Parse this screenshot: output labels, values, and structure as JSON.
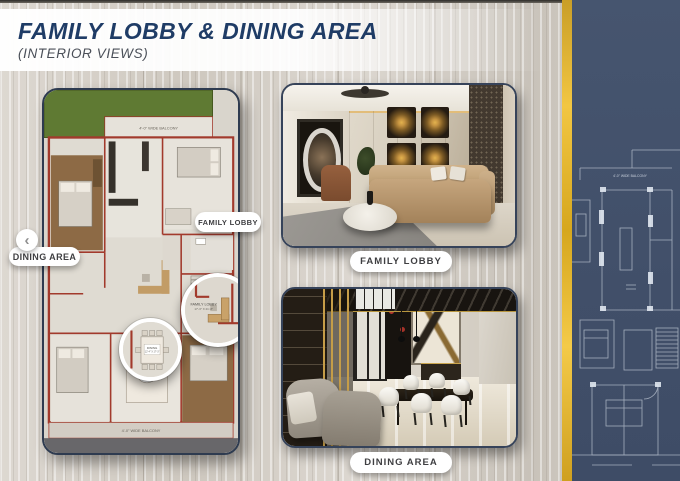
{
  "header": {
    "title": "FAMILY LOBBY & DINING AREA",
    "subtitle": "(INTERIOR VIEWS)"
  },
  "floorplan": {
    "balcony_top": "4'-0\" WIDE BALCONY",
    "balcony_bottom": "4'-0\" WIDE BALCONY",
    "magnifiers": {
      "family_lobby": {
        "label": "FAMILY LOBBY",
        "dims": "17'-3\" X 21'-8\""
      },
      "dining": {
        "label": "DINING",
        "dims": "12'-4\" X 17'-3\""
      }
    },
    "callouts": {
      "family_lobby": "FAMILY LOBBY",
      "dining_area": "DINING AREA"
    },
    "nav": {
      "prev": "‹"
    }
  },
  "photos": [
    {
      "label": "FAMILY LOBBY"
    },
    {
      "label": "DINING AREA"
    }
  ],
  "blueprint": {
    "balcony": "4'-0\" WIDE BALCONY"
  },
  "colors": {
    "accent_gold": "#E9B843",
    "panel_navy": "#43526C",
    "title_navy": "#1F3C66",
    "plan_wall_red": "#A23A2C",
    "grass_green": "#5F7A33"
  }
}
